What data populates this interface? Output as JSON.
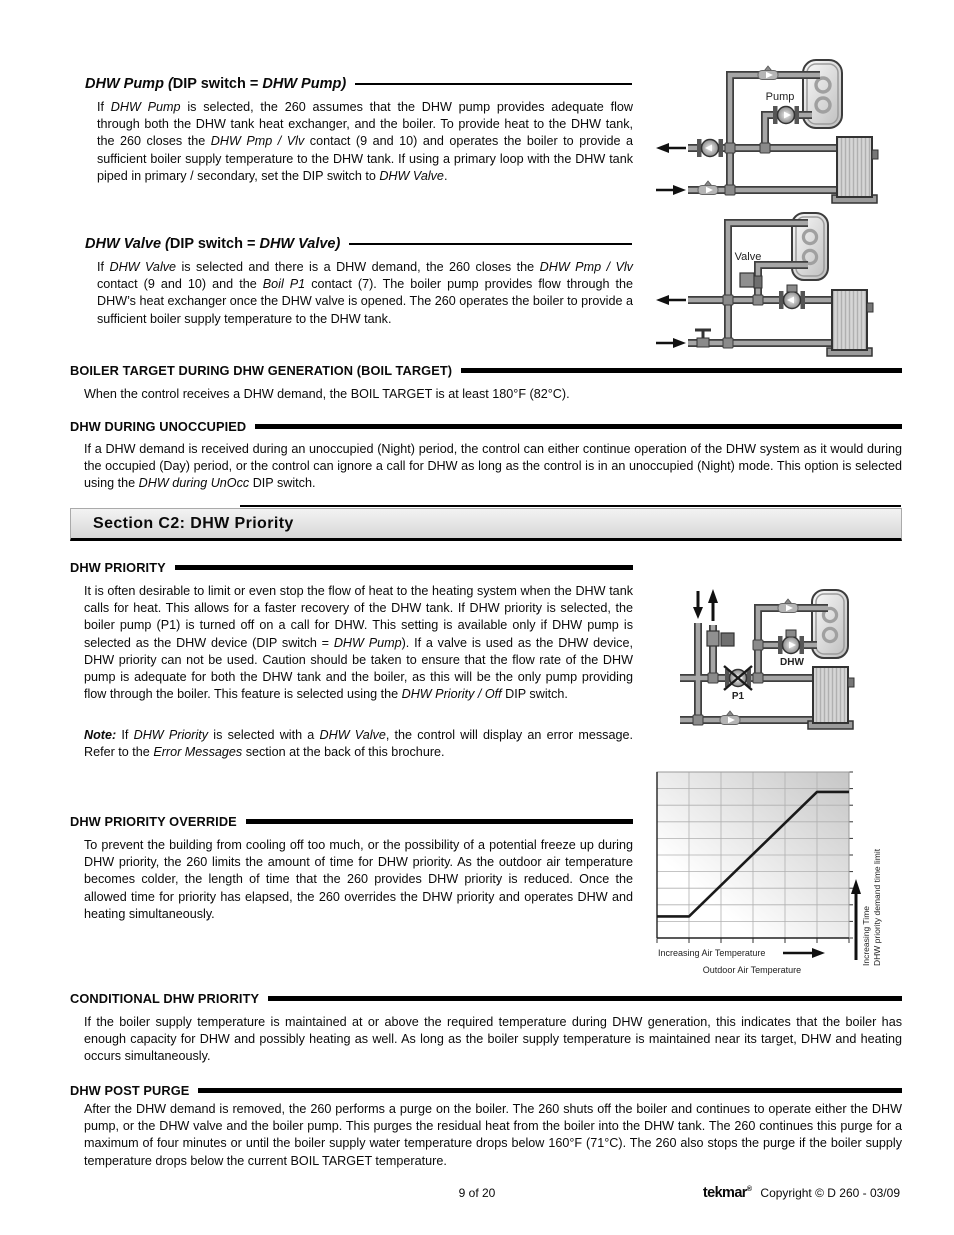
{
  "sections": {
    "dhw_pump": {
      "heading": [
        {
          "t": "DHW Pump (",
          "i": 1
        },
        {
          "t": "DIP switch = "
        },
        {
          "t": "DHW Pump)",
          "i": 1
        }
      ],
      "body": [
        {
          "t": "If "
        },
        {
          "t": "DHW Pump",
          "i": 1
        },
        {
          "t": " is selected, the 260 assumes that the DHW pump provides adequate flow through both the DHW tank heat exchanger, and the boiler. To provide heat to the DHW tank, the 260 closes the "
        },
        {
          "t": "DHW Pmp / Vlv",
          "i": 1
        },
        {
          "t": " contact (9 and 10) and operates the boiler to provide a sufficient boiler supply temperature to the DHW tank. If using a primary loop with the DHW tank piped in primary / secondary, set the DIP switch to "
        },
        {
          "t": "DHW Valve",
          "i": 1
        },
        {
          "t": "."
        }
      ]
    },
    "dhw_valve": {
      "heading": [
        {
          "t": "DHW Valve (",
          "i": 1
        },
        {
          "t": "DIP switch = "
        },
        {
          "t": "DHW Valve)",
          "i": 1
        }
      ],
      "body": [
        {
          "t": "If "
        },
        {
          "t": "DHW Valve",
          "i": 1
        },
        {
          "t": " is selected and there is a DHW demand, the 260 closes the "
        },
        {
          "t": "DHW Pmp / Vlv",
          "i": 1
        },
        {
          "t": " contact (9 and 10) and the "
        },
        {
          "t": "Boil P1",
          "i": 1
        },
        {
          "t": " contact (7). The boiler pump provides flow through the DHW’s heat exchanger once the DHW valve is opened. The 260 operates the boiler to provide a sufficient boiler supply temperature to the DHW tank."
        }
      ]
    },
    "boil_target": {
      "heading": "BOILER TARGET DURING DHW GENERATION (BOIL TARGET)",
      "body": [
        {
          "t": "When the control receives a DHW demand, the BOIL TARGET is at least 180°F (82°C)."
        }
      ]
    },
    "dhw_unocc": {
      "heading": "DHW DURING UNOCCUPIED",
      "body": [
        {
          "t": "If a DHW demand is received during an unoccupied (Night) period, the control can either continue operation of the DHW system as it would during the occupied (Day) period, or the control can ignore a call for DHW as long as the control is in an unoccupied (Night) mode. This option is selected using the "
        },
        {
          "t": "DHW during UnOcc",
          "i": 1
        },
        {
          "t": " DIP switch."
        }
      ]
    },
    "banner": {
      "title": "Section C2: DHW Priority"
    },
    "dhw_priority": {
      "heading": "DHW PRIORITY",
      "body": [
        {
          "t": "It is often desirable to limit or even stop the flow of heat to the heating system when the DHW tank calls for heat. This allows for a faster recovery of the DHW tank. If DHW priority is selected, the boiler pump (P1) is turned off on a call for DHW. This setting is available only if DHW pump is selected as the DHW device (DIP switch = "
        },
        {
          "t": "DHW Pump",
          "i": 1
        },
        {
          "t": "). If a valve is used as the DHW device, DHW priority can not be used. Caution should be taken to ensure that the flow rate of the DHW pump is adequate for both the DHW tank and the boiler, as this will be the only pump providing flow through the boiler. This feature is selected using the "
        },
        {
          "t": "DHW Priority / Off",
          "i": 1
        },
        {
          "t": " DIP switch."
        }
      ],
      "note": [
        {
          "t": "Note:",
          "b": 1,
          "i": 1
        },
        {
          "t": " If "
        },
        {
          "t": "DHW Priority",
          "i": 1
        },
        {
          "t": " is selected with a "
        },
        {
          "t": "DHW Valve",
          "i": 1
        },
        {
          "t": ", the control will display an error message. Refer to the "
        },
        {
          "t": "Error Messages",
          "i": 1
        },
        {
          "t": " section at the back of this brochure."
        }
      ]
    },
    "priority_override": {
      "heading": "DHW PRIORITY OVERRIDE",
      "body": [
        {
          "t": "To prevent the building from cooling off too much, or the possibility of a potential freeze up during DHW priority, the 260 limits the amount of time for DHW priority. As the outdoor air temperature becomes colder, the length of time that the 260 provides DHW priority is reduced. Once the allowed time for priority has elapsed, the 260 overrides the DHW priority and operates DHW and heating simultaneously."
        }
      ]
    },
    "conditional": {
      "heading": "CONDITIONAL DHW PRIORITY",
      "body": [
        {
          "t": "If the boiler supply temperature is maintained at or above the required temperature during DHW generation, this indicates that the boiler has enough capacity for DHW and possibly heating as well. As long as the boiler supply temperature is maintained near its target, DHW and heating occurs simultaneously."
        }
      ]
    },
    "post_purge": {
      "heading": "DHW POST PURGE",
      "body": [
        {
          "t": "After the DHW demand is removed, the 260 performs a purge on the boiler. The 260 shuts off the boiler and continues to operate either the DHW pump, or the DHW valve and the boiler pump. This purges the residual heat from the boiler into the DHW tank. The 260 continues this purge for a maximum of four minutes or until the boiler supply water temperature drops below 160°F (71°C). The 260 also stops the purge if the boiler supply temperature drops below the current BOIL TARGET temperature."
        }
      ]
    }
  },
  "figures": {
    "pump_diagram": {
      "caption_label": "Pump"
    },
    "valve_diagram": {
      "caption_label": "Valve"
    },
    "priority_diagram": {
      "pump_label": "P1",
      "dhw_label": "DHW"
    }
  },
  "chart_data": {
    "type": "line",
    "x_arrow_label": "Increasing Air Temperature",
    "xlabel": "Outdoor Air Temperature",
    "ylabel_line1": "Increasing Time",
    "ylabel_line2": "DHW priority demand time limit",
    "x": [
      0,
      1,
      5,
      6
    ],
    "y": [
      1.3,
      1.3,
      8.8,
      8.8
    ],
    "xlim": [
      0,
      6
    ],
    "ylim": [
      0,
      10
    ],
    "grid": true,
    "grid_divisions": {
      "x": 6,
      "y": 10
    },
    "legend": []
  },
  "footer": {
    "page_number": "9 of 20",
    "brand": "tekmar",
    "brand_mark": "®",
    "copyright": "Copyright © D 260 - 03/09"
  },
  "colors": {
    "ink": "#000000",
    "banner_bg_top": "#f3f3f3",
    "banner_bg_bottom": "#d7d7d7",
    "pipe_gray": "#a6a6a6",
    "diagram_outline": "#3f3f3f"
  }
}
